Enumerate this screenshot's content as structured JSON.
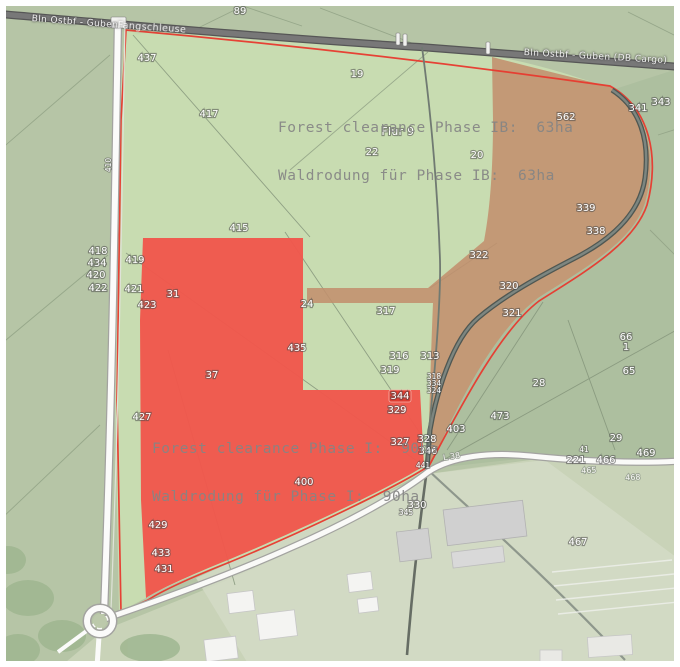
{
  "map": {
    "railway": {
      "label_left": "Bln Ostbf - Guben",
      "label_right": "Bln Ostbf - Guben (DB Cargo)",
      "station_label": "Fangschleuse"
    },
    "annotations": {
      "phase_ib_en": "Forest clearance Phase IB:  63ha",
      "phase_ib_de": "Waldrodung für Phase IB:  63ha",
      "phase_i_en": "Forest clearance Phase I:  90ha",
      "phase_i_de": "Waldrodung für Phase I:  90ha"
    },
    "road_labels": [
      {
        "text": "L 38",
        "x": 452,
        "y": 459,
        "rotate": -9
      },
      {
        "text": "465",
        "x": 589,
        "y": 473,
        "rotate": -4
      },
      {
        "text": "468",
        "x": 633,
        "y": 480,
        "rotate": -3
      }
    ],
    "parcel_labels": [
      {
        "text": "89",
        "x": 240,
        "y": 14
      },
      {
        "text": "437",
        "x": 147,
        "y": 61
      },
      {
        "text": "417",
        "x": 209,
        "y": 117
      },
      {
        "text": "19",
        "x": 357,
        "y": 77
      },
      {
        "text": "Flur 9",
        "x": 398,
        "y": 135,
        "cls": "flur"
      },
      {
        "text": "22",
        "x": 372,
        "y": 155
      },
      {
        "text": "20",
        "x": 477,
        "y": 158
      },
      {
        "text": "562",
        "x": 566,
        "y": 120
      },
      {
        "text": "341",
        "x": 638,
        "y": 111
      },
      {
        "text": "343",
        "x": 661,
        "y": 105
      },
      {
        "text": "339",
        "x": 586,
        "y": 211
      },
      {
        "text": "338",
        "x": 596,
        "y": 234
      },
      {
        "text": "415",
        "x": 239,
        "y": 231
      },
      {
        "text": "418",
        "x": 98,
        "y": 254
      },
      {
        "text": "434",
        "x": 97,
        "y": 266
      },
      {
        "text": "420",
        "x": 96,
        "y": 278
      },
      {
        "text": "422",
        "x": 98,
        "y": 291
      },
      {
        "text": "419",
        "x": 135,
        "y": 263
      },
      {
        "text": "421",
        "x": 134,
        "y": 292
      },
      {
        "text": "423",
        "x": 147,
        "y": 308
      },
      {
        "text": "31",
        "x": 173,
        "y": 297
      },
      {
        "text": "410",
        "x": 111,
        "y": 165,
        "rotate": -90,
        "cls": "tiny"
      },
      {
        "text": "322",
        "x": 479,
        "y": 258
      },
      {
        "text": "320",
        "x": 509,
        "y": 289
      },
      {
        "text": "321",
        "x": 512,
        "y": 316
      },
      {
        "text": "24",
        "x": 307,
        "y": 307
      },
      {
        "text": "317",
        "x": 386,
        "y": 314
      },
      {
        "text": "435",
        "x": 297,
        "y": 351
      },
      {
        "text": "37",
        "x": 212,
        "y": 378
      },
      {
        "text": "316",
        "x": 399,
        "y": 359
      },
      {
        "text": "313",
        "x": 430,
        "y": 359
      },
      {
        "text": "319",
        "x": 390,
        "y": 373
      },
      {
        "text": "318",
        "x": 434,
        "y": 379,
        "cls": "tiny"
      },
      {
        "text": "334",
        "x": 434,
        "y": 386,
        "cls": "tiny"
      },
      {
        "text": "324",
        "x": 434,
        "y": 393,
        "cls": "tiny"
      },
      {
        "text": "344",
        "x": 400,
        "y": 399,
        "chip": true
      },
      {
        "text": "329",
        "x": 397,
        "y": 413
      },
      {
        "text": "327",
        "x": 400,
        "y": 445
      },
      {
        "text": "328",
        "x": 427,
        "y": 442
      },
      {
        "text": "346",
        "x": 428,
        "y": 454
      },
      {
        "text": "441",
        "x": 423,
        "y": 468,
        "cls": "tiny"
      },
      {
        "text": "403",
        "x": 456,
        "y": 432
      },
      {
        "text": "473",
        "x": 500,
        "y": 419
      },
      {
        "text": "28",
        "x": 539,
        "y": 386
      },
      {
        "text": "66",
        "x": 626,
        "y": 340
      },
      {
        "text": "1",
        "x": 626,
        "y": 350
      },
      {
        "text": "65",
        "x": 629,
        "y": 374
      },
      {
        "text": "29",
        "x": 616,
        "y": 441
      },
      {
        "text": "41",
        "x": 584,
        "y": 452,
        "cls": "tiny"
      },
      {
        "text": "221",
        "x": 576,
        "y": 463
      },
      {
        "text": "466",
        "x": 606,
        "y": 463
      },
      {
        "text": "469",
        "x": 646,
        "y": 456
      },
      {
        "text": "400",
        "x": 304,
        "y": 485
      },
      {
        "text": "330",
        "x": 417,
        "y": 508
      },
      {
        "text": "345",
        "x": 406,
        "y": 515,
        "cls": "tiny"
      },
      {
        "text": "427",
        "x": 142,
        "y": 420
      },
      {
        "text": "429",
        "x": 158,
        "y": 528
      },
      {
        "text": "433",
        "x": 161,
        "y": 556
      },
      {
        "text": "431",
        "x": 164,
        "y": 572
      },
      {
        "text": "467",
        "x": 578,
        "y": 545
      }
    ],
    "colors": {
      "phase_i_red": "#f0564c",
      "phase_ib_tan": "#c2906d",
      "boundary_red": "#e8392e",
      "annotation_gray": "#858585",
      "map_green_base": "#b6c5a6",
      "parcel_light_green": "#c9deb2",
      "railway_gray": "#6f6f6f",
      "road_white": "#fafaf8"
    }
  }
}
